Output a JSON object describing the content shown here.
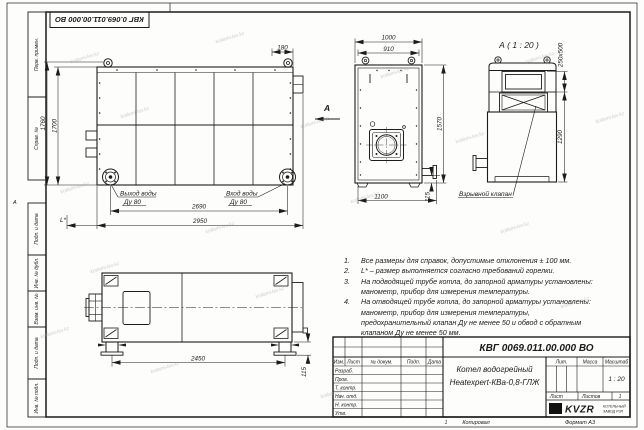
{
  "watermark": {
    "text": "kotlami-lev.kz"
  },
  "frame": {
    "top_code_stamp": "КВГ 0.069.011.00.000 ВО",
    "margin_stamps": [
      "Перв. примен.",
      "Справ. №",
      "Подп. и дата",
      "Инв. № дубл.",
      "Взам. инв. №",
      "Подп. и дата",
      "Инв. № подл."
    ],
    "zone_letter_left": "А",
    "zone_number_bottom": "1",
    "copied_label": "Копировал",
    "format_label": "Формат А3"
  },
  "views": {
    "side_view": {
      "dim_height_overall": "1760",
      "dim_height_body": "1700",
      "dim_flue_offset": "180",
      "dim_width_wheels": "2690",
      "dim_width_overall": "2950",
      "dim_l_star": "L*",
      "label_water_outlet": "Выход воды",
      "label_water_outlet_dn": "Ду 80",
      "label_water_inlet": "Вход воды",
      "label_water_inlet_dn": "Ду 80",
      "view_arrow_label": "А"
    },
    "front_view": {
      "dim_width_top": "1000",
      "dim_width_lugs": "910",
      "dim_height": "1570",
      "dim_width_base": "1100",
      "dim_stub_offset": "115",
      "label_explosion_valve": "Взрывной клапан"
    },
    "detail_view": {
      "title": "А ( 1 : 20 )",
      "dim_opening": "250x500",
      "dim_height": "1290"
    },
    "top_view": {
      "dim_legs_span": "2450",
      "dim_leg_height": "115"
    }
  },
  "notes": [
    {
      "num": "1.",
      "text": "Все размеры для справок, допустимые отклонения ± 100 мм."
    },
    {
      "num": "2.",
      "text": "L* – размер выполняется согласно требований горелки."
    },
    {
      "num": "3.",
      "text": "На подводящей трубе котла, до запорной арматуры установлены: манометр, прибор для измерения температуры."
    },
    {
      "num": "4.",
      "text": "На отводящей трубе котла, до запорной арматуры установлены: манометр, прибор для измерения температуры, предохранительный клапан Ду не менее 50 и обвод с обратным клапаном Ду не менее 50 мм."
    }
  ],
  "title_block": {
    "document_code": "КВГ 0069.011.00.000 ВО",
    "product_name_line1": "Котел водогрейный",
    "product_name_line2": "Heatexpert-КВа-0,8-ГЛЖ",
    "header_columns": [
      "Изм.",
      "Лист",
      "№ докум.",
      "Подп.",
      "Дата"
    ],
    "signature_rows": [
      "Разраб.",
      "Пров.",
      "Т. контр.",
      "Нач. отд.",
      "Н. контр.",
      "Утв."
    ],
    "lit_label": "Лит.",
    "mass_label": "Масса",
    "scale_label": "Масштаб",
    "scale_value": "1 : 20",
    "sheet_label": "Лист",
    "sheets_label": "Листов",
    "sheets_value": "1",
    "company_logo_text": "KVZR",
    "company_name_line1": "КОТЕЛЬНЫЙ",
    "company_name_line2": "ЗАВОД РЗЛ"
  }
}
